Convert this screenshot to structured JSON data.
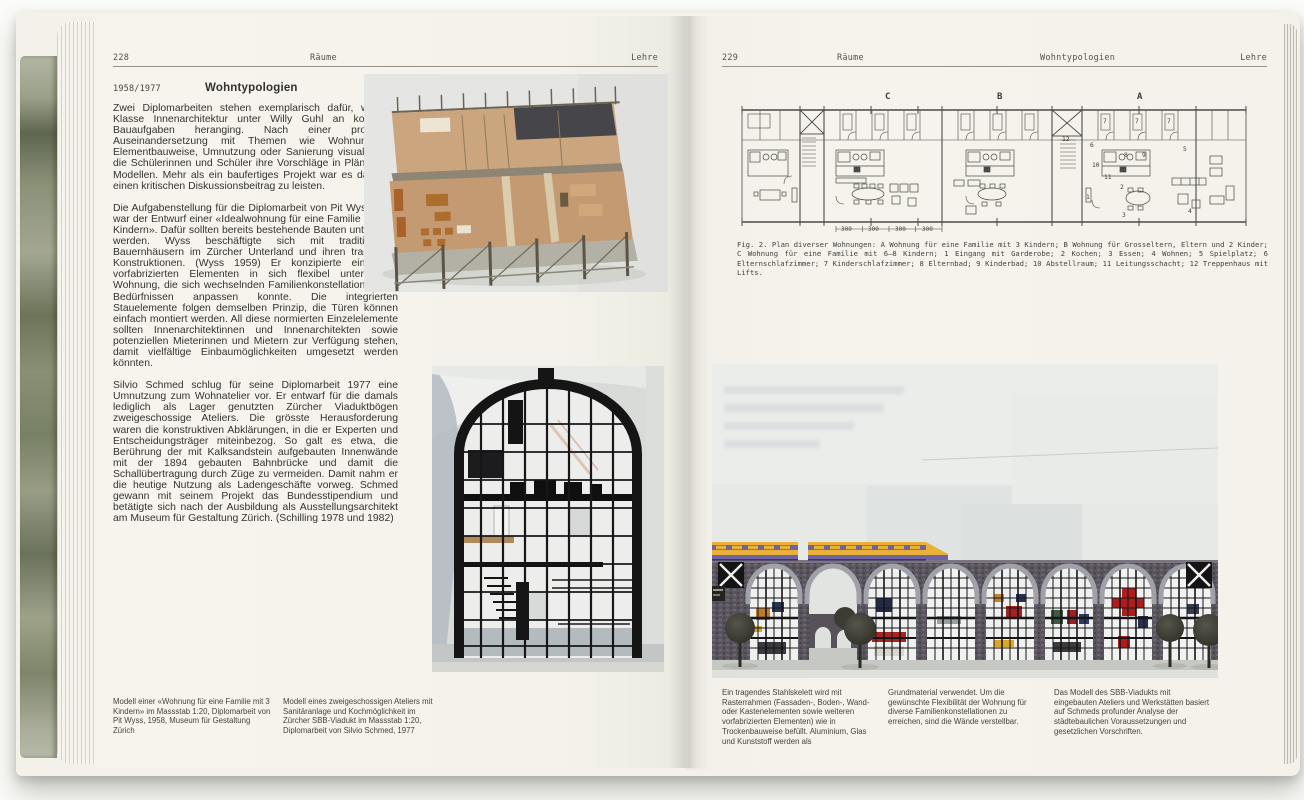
{
  "colors": {
    "page_cream": "#f4f2ea",
    "fore_edge_green": "#7d8570",
    "photo_background_gray": "#e4e6e3",
    "train_yellow": "#e9b13a",
    "train_purple": "#6f63a5",
    "viaduct_brick": "#595259",
    "model_wood": "#c49a72",
    "ink": "#34332e"
  },
  "left_page": {
    "page_number": "228",
    "running_head_center": "Räume",
    "running_head_right": "Lehre",
    "date_label": "1958/1977",
    "title": "Wohntypologien",
    "paragraphs": [
      "Zwei Diplomarbeiten stehen exemplarisch dafür, wie die Klasse Innenarchitektur unter Willy Guhl an komplexe Bauaufgaben heranging. Nach einer profunden Auseinandersetzung mit Themen wie Wohnungsbau, Elementbauweise, Umnutzung oder Sanierung visualisierten die Schülerinnen und Schüler ihre Vorschläge in Plänen und Modellen. Mehr als ein baufertiges Projekt war es das Ziel, einen kritischen Diskussionsbeitrag zu leisten.",
      "Die Aufgabenstellung für die Diplomarbeit von Pit Wyss 1958 war der Entwurf einer «Idealwohnung für eine Familie mit drei Kindern». Dafür sollten bereits bestehende Bauten untersucht werden. Wyss beschäftigte sich mit traditionellen Bauernhäusern im Zürcher Unterland und ihren tragenden Konstruktionen. (Wyss 1959) Er konzipierte eine aus vorfabrizierten Elementen in sich flexibel unterteilbare Wohnung, die sich wechselnden Familienkonstellationen und Bedürfnissen anpassen konnte. Die integrierten Stauelemente folgen demselben Prinzip, die Türen können einfach montiert werden. All diese normierten Einzelelemente sollten Innenarchitektinnen und Innenarchitekten sowie potenziellen Mieterinnen und Mietern zur Verfügung stehen, damit vielfältige Einbaumöglichkeiten umgesetzt werden könnten.",
      "Silvio Schmed schlug für seine Diplomarbeit 1977 eine Umnutzung zum Wohnatelier vor. Er entwarf für die damals lediglich als Lager genutzten Zürcher Viaduktbögen zweigeschossige Ateliers. Die grösste Herausforderung waren die konstruktiven Abklärungen, in die er Experten und Entscheidungsträger miteinbezog. So galt es etwa, die Berührung der mit Kalksandstein aufgebauten Innenwände mit der 1894 gebauten Bahnbrücke und damit die Schallübertragung durch Züge zu vermeiden. Damit nahm er die heutige Nutzung als Ladengeschäfte vorweg. Schmed gewann mit seinem Projekt das Bundesstipendium und betätigte sich nach der Ausbildung als Ausstellungsarchitekt am Museum für Gestaltung Zürich. (Schilling 1978 und 1982)"
    ],
    "captions": [
      "Modell einer «Wohnung für eine Familie mit 3 Kindern» im Massstab 1:20, Diplomarbeit von Pit Wyss, 1958, Museum für Gestaltung Zürich",
      "Modell eines zweigeschossigen Ateliers mit Sanitäranlage und Kochmöglichkeit im Zürcher SBB-Viadukt im Massstab 1:20, Diplomarbeit von Silvio Schmed, 1977"
    ]
  },
  "right_page": {
    "page_number": "229",
    "running_head_left": "Räume",
    "running_head_center": "Wohntypologien",
    "running_head_right": "Lehre",
    "figure_caption": "Fig. 2. Plan diverser Wohnungen: A Wohnung für eine Familie mit 3 Kindern; B Wohnung für Grosseltern, Eltern und 2 Kinder; C Wohnung für eine Familie mit 6–8 Kindern; 1 Eingang mit Garderobe; 2 Kochen; 3 Essen; 4 Wohnen; 5 Spielplatz; 6 Elternschlafzimmer; 7 Kinderschlafzimmer; 8 Elternbad; 9 Kinderbad; 10 Abstellraum; 11 Leitungsschacht; 12 Treppenhaus mit Lifts.",
    "plan": {
      "section_labels": {
        "c": "C",
        "b": "B",
        "a": "A"
      },
      "room_numbers": {
        "r12": "12",
        "r7a": "7",
        "r7b": "7",
        "r7c": "7",
        "r6": "6",
        "r5": "5",
        "r10": "10",
        "r8": "8",
        "r9": "9",
        "r11": "11",
        "r2": "2",
        "r1": "1",
        "r3": "3",
        "r4": "4"
      },
      "dimensions": {
        "d1": "300",
        "d2": "300",
        "d3": "300",
        "d4": "300"
      }
    },
    "captions": [
      "Ein tragendes Stahlskelett wird mit Rasterrahmen (Fassaden-, Boden-, Wand- oder Kastenelementen sowie weiteren vorfabrizierten Elementen) wie in Trockenbauweise befüllt. Aluminium, Glas und Kunststoff werden als",
      "Grundmaterial verwendet. Um die gewünschte Flexibilität der Wohnung für diverse Familienkonstellationen zu erreichen, sind die Wände verstellbar.",
      "Das Modell des SBB-Viadukts mit eingebauten Ateliers und Werkstätten basiert auf Schmeds profunder Analyse der städtebaulichen Voraussetzungen und gesetzlichen Vorschriften."
    ]
  }
}
